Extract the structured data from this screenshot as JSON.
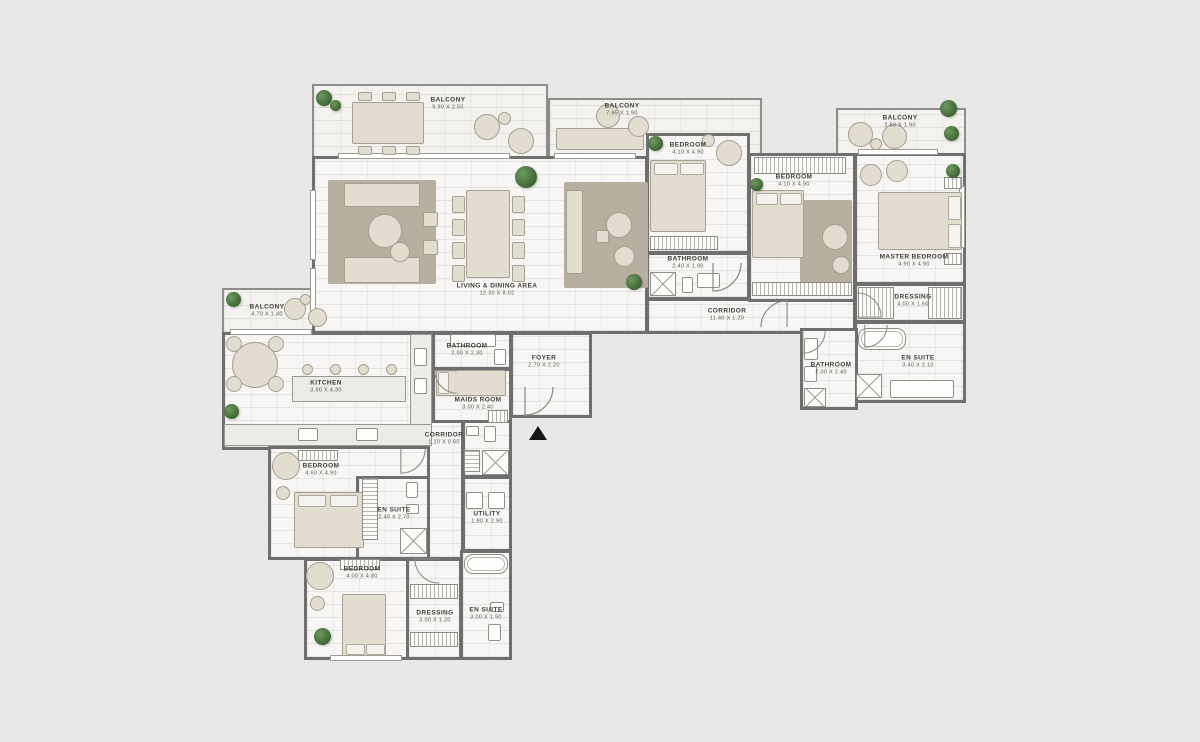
{
  "canvas": {
    "width": 1200,
    "height": 742,
    "background": "#e8e8e8"
  },
  "colors": {
    "wall": "#6f6f6f",
    "floor": "#f7f6f4",
    "balcony_floor": "#f3f2ee",
    "furniture": "#e2ddcf",
    "rug": "#b7b0a1",
    "plant": "#4a7340",
    "entrance_marker": "#161616"
  },
  "entrance": {
    "symbol": "up-triangle"
  },
  "rooms": [
    {
      "name": "BALCONY",
      "dims": "9.90 X 2.50"
    },
    {
      "name": "BALCONY",
      "dims": "7.95 X 1.90"
    },
    {
      "name": "BALCONY",
      "dims": "2.60 X 1.90"
    },
    {
      "name": "BEDROOM",
      "dims": "4.10 X 4.90"
    },
    {
      "name": "BATHROOM",
      "dims": "2.40 X 1.90"
    },
    {
      "name": "BEDROOM",
      "dims": "4.10 X 4.90"
    },
    {
      "name": "MASTER BEDROOM",
      "dims": "4.90 X 4.90"
    },
    {
      "name": "DRESSING",
      "dims": "4.00 X 1.60"
    },
    {
      "name": "EN SUITE",
      "dims": "3.40 X 2.10"
    },
    {
      "name": "BATHROOM",
      "dims": "2.00 X 2.40"
    },
    {
      "name": "CORRIDOR",
      "dims": "11.40 X 1.20"
    },
    {
      "name": "LIVING & DINING AREA",
      "dims": "12.30 X 8.02"
    },
    {
      "name": "BALCONY",
      "dims": "4.70 X 1.40"
    },
    {
      "name": "KITCHEN",
      "dims": "3.90 X 4.30"
    },
    {
      "name": "BATHROOM",
      "dims": "2.00 X 2.30"
    },
    {
      "name": "MAIDS ROOM",
      "dims": "3.00 X 2.40"
    },
    {
      "name": "FOYER",
      "dims": "2.70 X 2.20"
    },
    {
      "name": "CORRIDOR",
      "dims": "1.10 X 0.60"
    },
    {
      "name": "BEDROOM",
      "dims": "4.60 X 4.90"
    },
    {
      "name": "EN SUITE",
      "dims": "2.40 X 2.70"
    },
    {
      "name": "UTILITY",
      "dims": "1.80 X 2.90"
    },
    {
      "name": "BEDROOM",
      "dims": "4.00 X 4.80"
    },
    {
      "name": "DRESSING",
      "dims": "3.00 X 1.20"
    },
    {
      "name": "EN SUITE",
      "dims": "3.00 X 1.90"
    }
  ]
}
